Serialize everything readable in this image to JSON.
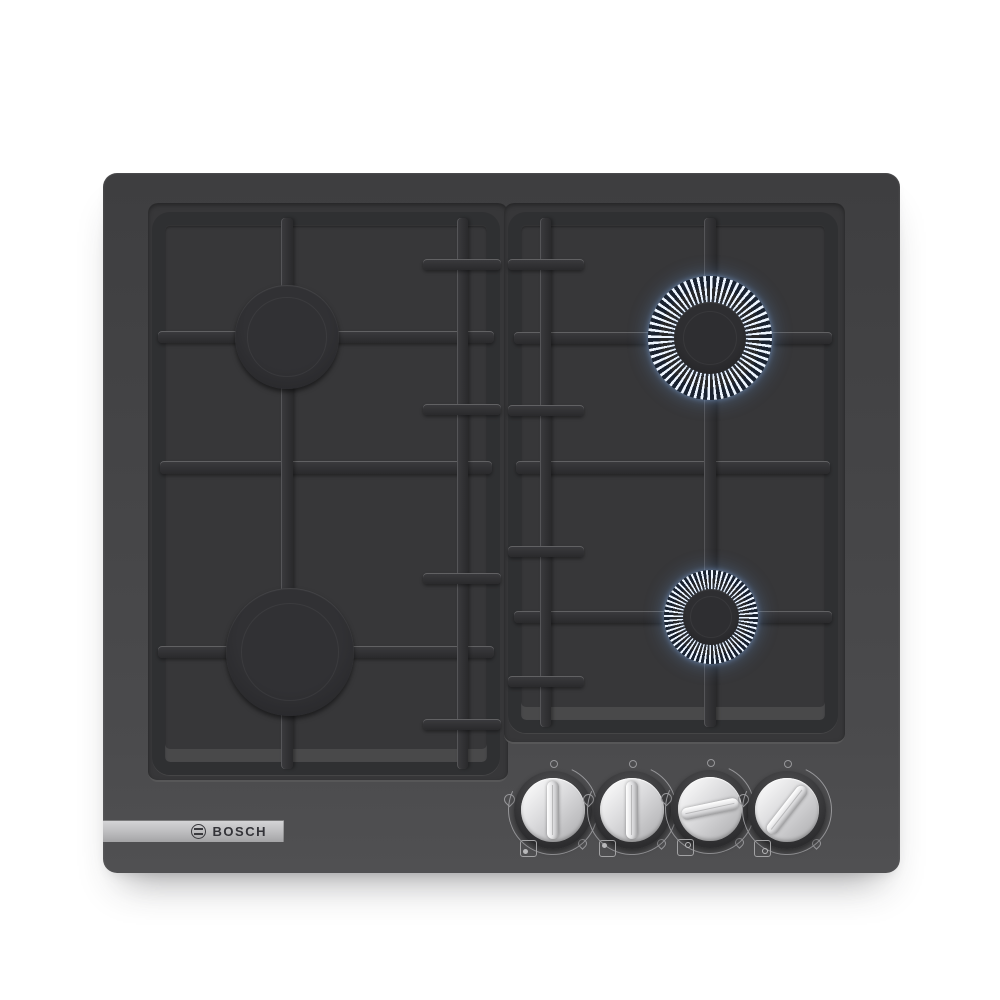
{
  "brand": {
    "label": "BOSCH"
  },
  "colors": {
    "page_bg": "#ffffff",
    "glass_top": "#3e3e40",
    "glass_bottom": "#505052",
    "recess": "#373739",
    "grate": "#2f3032",
    "burner_cap": "#28282a",
    "flame_white": "#edf5ff",
    "flame_blue": "#6d9fd8",
    "flame_dark": "#1c2736",
    "knob_silver": "#d9d9db",
    "brand_strip": "#b9b9bb"
  },
  "burners": [
    {
      "position": "back-left",
      "size": "medium",
      "lit": false
    },
    {
      "position": "back-right",
      "size": "large",
      "lit": true
    },
    {
      "position": "front-left",
      "size": "large",
      "lit": false
    },
    {
      "position": "front-right",
      "size": "small",
      "lit": true
    }
  ],
  "knobs": [
    {
      "label": "front-left burner knob",
      "state": "off",
      "rotation_deg": 0,
      "dot_corner": "bottom-left",
      "dot_filled": true
    },
    {
      "label": "back-left burner knob",
      "state": "off",
      "rotation_deg": 0,
      "dot_corner": "top-left",
      "dot_filled": true
    },
    {
      "label": "back-right burner knob",
      "state": "on",
      "rotation_deg": 78,
      "dot_corner": "top-right",
      "dot_filled": false
    },
    {
      "label": "front-right burner knob",
      "state": "on",
      "rotation_deg": 38,
      "dot_corner": "bottom-right",
      "dot_filled": false
    }
  ]
}
